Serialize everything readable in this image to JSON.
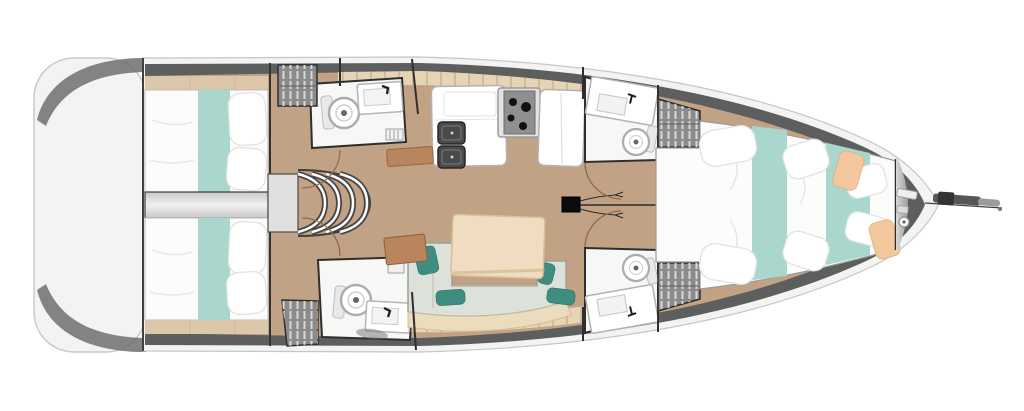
{
  "meta": {
    "title": "Sailing yacht interior deck plan, top-down, bow pointing right",
    "orientation": "bow-right",
    "style": "architectural floor plan rendering, no text labels"
  },
  "colors": {
    "deck_white": "#f3f3f2",
    "hull_band": "#5d5e5e",
    "floor_tan": "#c2a284",
    "floor_light": "#dcc8a9",
    "tile_band": "#e6d4b6",
    "tile_line": "#c6b291",
    "bed_white": "#fcfcfb",
    "bed_teal": "#a9d6cd",
    "room_white": "#f7f7f6",
    "locker_gray": "#8b8b8b",
    "locker_stripe": "#d8d8d8",
    "settee": "#dce1d9",
    "settee_back": "#ecdcbe",
    "table_beige": "#f0dcc0",
    "wood_brown": "#b9855e",
    "pillow_teal": "#3f8d80",
    "peach": "#f3c89e",
    "outline_dark": "#2e2e2e",
    "door_arc": "#8a6a4a",
    "rig_line": "#2b2b2b",
    "bow_gray": "#c6c6c6",
    "engine_light": "#ececec",
    "engine_dark": "#c8c8c8",
    "anchor_dark": "#565656",
    "anchor_light": "#9b9b9b"
  },
  "areas": {
    "boat": "Sailing yacht deck plan",
    "stern_platform": "Stern swim platform / transom",
    "aft_cabin_top": "Aft double cabin (port) with teal-striped berth",
    "aft_cabin_bottom": "Aft double cabin (starboard) with teal-striped berth",
    "engine_compartment": "Engine compartment between aft cabins",
    "companionway": "Companionway steps (4 curved treads)",
    "aft_head_top": "Aft head with toilet and sink (port)",
    "aft_head_bottom": "Aft head with toilet and sink (starboard)",
    "hanging_lockers": "Hanging lockers (striped)",
    "galley": "Galley with double sink, stove and counters",
    "salon": "Salon with U-shaped settee, table and teal cushions",
    "chart_table": "Chart table / nav desk",
    "mast": "Mast foot with rigging centerline",
    "fwd_head_top": "Forward head with sink and toilet (port)",
    "fwd_head_bottom": "Forward head with sink and toilet (starboard)",
    "fwd_cabin": "Forward owner cabin with V-berth",
    "bow_locker": "Bow anchor locker with windlass",
    "anchor": "Anchor and bowsprit fitting"
  },
  "fixtures": {
    "toilets": 4,
    "bathroom_sinks": 4,
    "galley_sink_basins": 2,
    "stove_burners": 4,
    "berths": 3,
    "companionway_steps": 4,
    "hanging_lockers": 4,
    "salon_cushions": 4
  }
}
